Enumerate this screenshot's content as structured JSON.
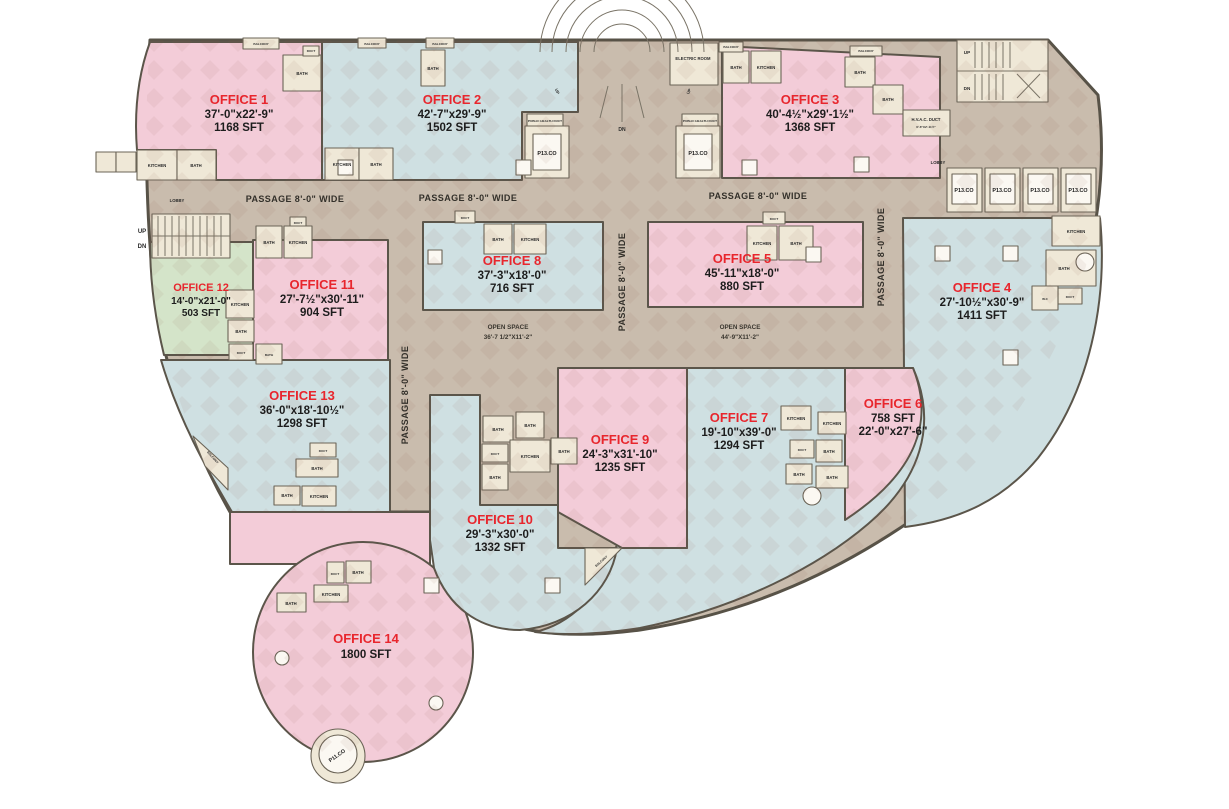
{
  "offices": [
    {
      "name": "OFFICE 1",
      "line2": "37'-0\"x22'-9\"",
      "line3": "1168 SFT"
    },
    {
      "name": "OFFICE 2",
      "line2": "42'-7\"x29'-9\"",
      "line3": "1502 SFT"
    },
    {
      "name": "OFFICE 3",
      "line2": "40'-4½\"x29'-1½\"",
      "line3": "1368 SFT"
    },
    {
      "name": "OFFICE 4",
      "line2": "27'-10½\"x30'-9\"",
      "line3": "1411 SFT"
    },
    {
      "name": "OFFICE 5",
      "line2": "45'-11\"x18'-0\"",
      "line3": "880 SFT"
    },
    {
      "name": "OFFICE 6",
      "line2": "758 SFT",
      "line3": "22'-0\"x27'-6\""
    },
    {
      "name": "OFFICE 7",
      "line2": "19'-10\"x39'-0\"",
      "line3": "1294 SFT"
    },
    {
      "name": "OFFICE 8",
      "line2": "37'-3\"x18'-0\"",
      "line3": "716 SFT"
    },
    {
      "name": "OFFICE 9",
      "line2": "24'-3\"x31'-10\"",
      "line3": "1235 SFT"
    },
    {
      "name": "OFFICE 10",
      "line2": "29'-3\"x30'-0\"",
      "line3": "1332 SFT"
    },
    {
      "name": "OFFICE 11",
      "line2": "27'-7½\"x30'-11\"",
      "line3": "904 SFT"
    },
    {
      "name": "OFFICE 12",
      "line2": "14'-0\"x21'-0\"",
      "line3": "503 SFT"
    },
    {
      "name": "OFFICE 13",
      "line2": "36'-0\"x18'-10½\"",
      "line3": "1298 SFT"
    },
    {
      "name": "OFFICE 14",
      "line2": "1800 SFT",
      "line3": ""
    }
  ],
  "labels": {
    "passage": "PASSAGE 8'-0\" WIDE",
    "open_space": "OPEN SPACE",
    "open_space_dims_1": "36'-7 1/2\"X11'-2\"",
    "open_space_dims_2": "44'-9\"X11'-2\"",
    "electric_room": "ELECTRIC ROOM",
    "hvac_duct": "H.V.A.C. DUCT",
    "hvac_duct_dims": "6'-6\"X2'-11½\"",
    "public_health_duct": "PUBLIC HEALTH DUCT",
    "lobby": "LOBBY",
    "passenger_lift": "P13.CO",
    "round_balcony_lift": "P11.CO",
    "up": "UP",
    "dn": "DN",
    "bath": "BATH",
    "kitchen": "KITCHEN",
    "duct": "DUCT",
    "balcony": "BALCONY",
    "wc": "W.C"
  },
  "colors": {
    "office_pink": "#f3ccd8",
    "office_blue": "#cfe0e2",
    "office_green": "#d4e4c9",
    "corridor_tan": "#c9bcad",
    "room_cream": "#efe8d7",
    "office_name_red": "#e8262d",
    "dimension_text": "#1d1d1d",
    "wall": "#5b554a"
  }
}
